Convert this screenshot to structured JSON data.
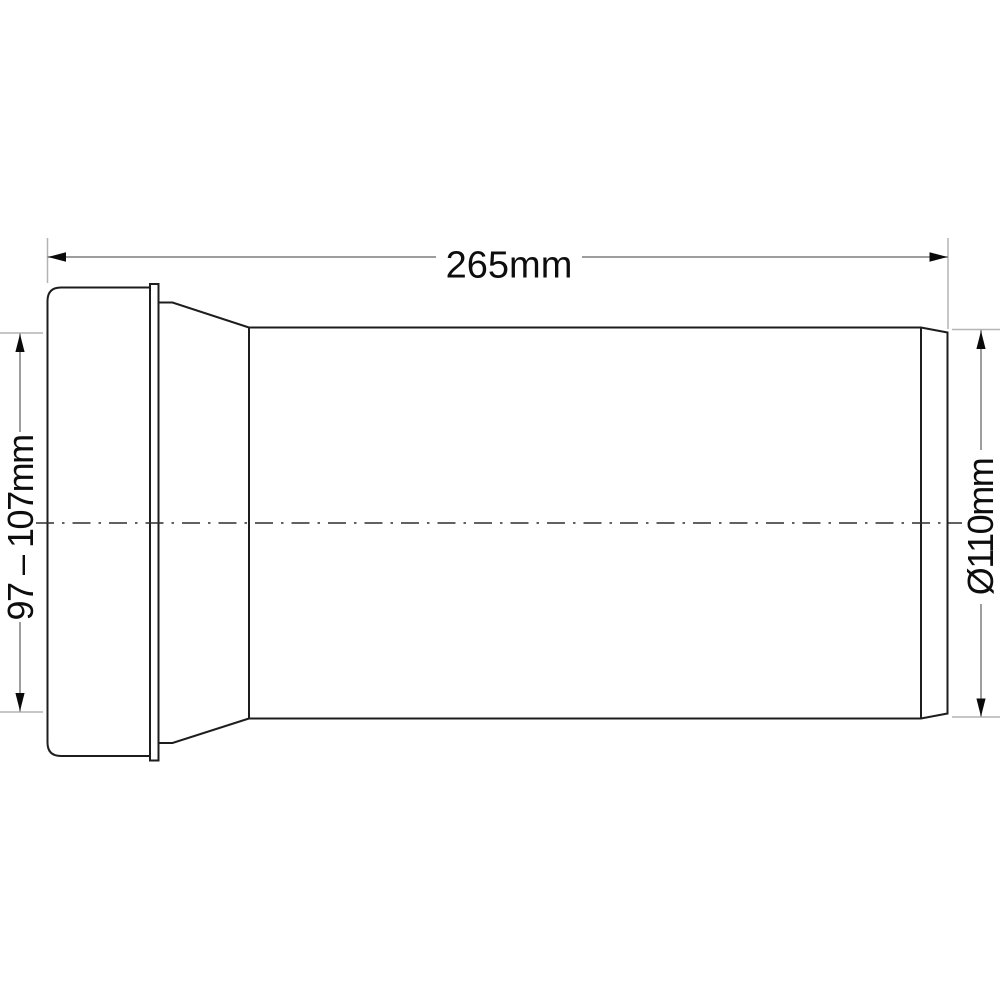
{
  "drawing": {
    "kind": "technical-dimension-drawing",
    "subject": "pipe-connector-side-view",
    "dimensions": {
      "length_label": "265mm",
      "length_mm": 265,
      "socket_range_label": "97 – 107mm",
      "socket_range_mm": [
        97,
        107
      ],
      "diameter_label": "Ø110mm",
      "diameter_mm": 110
    },
    "colors": {
      "background": "#ffffff",
      "part_outline": "#1d1d1d",
      "centerline": "#2e2e2e",
      "extension_line": "#b4b4b4",
      "dimension_line": "#7d7d7d",
      "arrow": "#0a0a0a",
      "text": "#0d0d0d"
    }
  }
}
